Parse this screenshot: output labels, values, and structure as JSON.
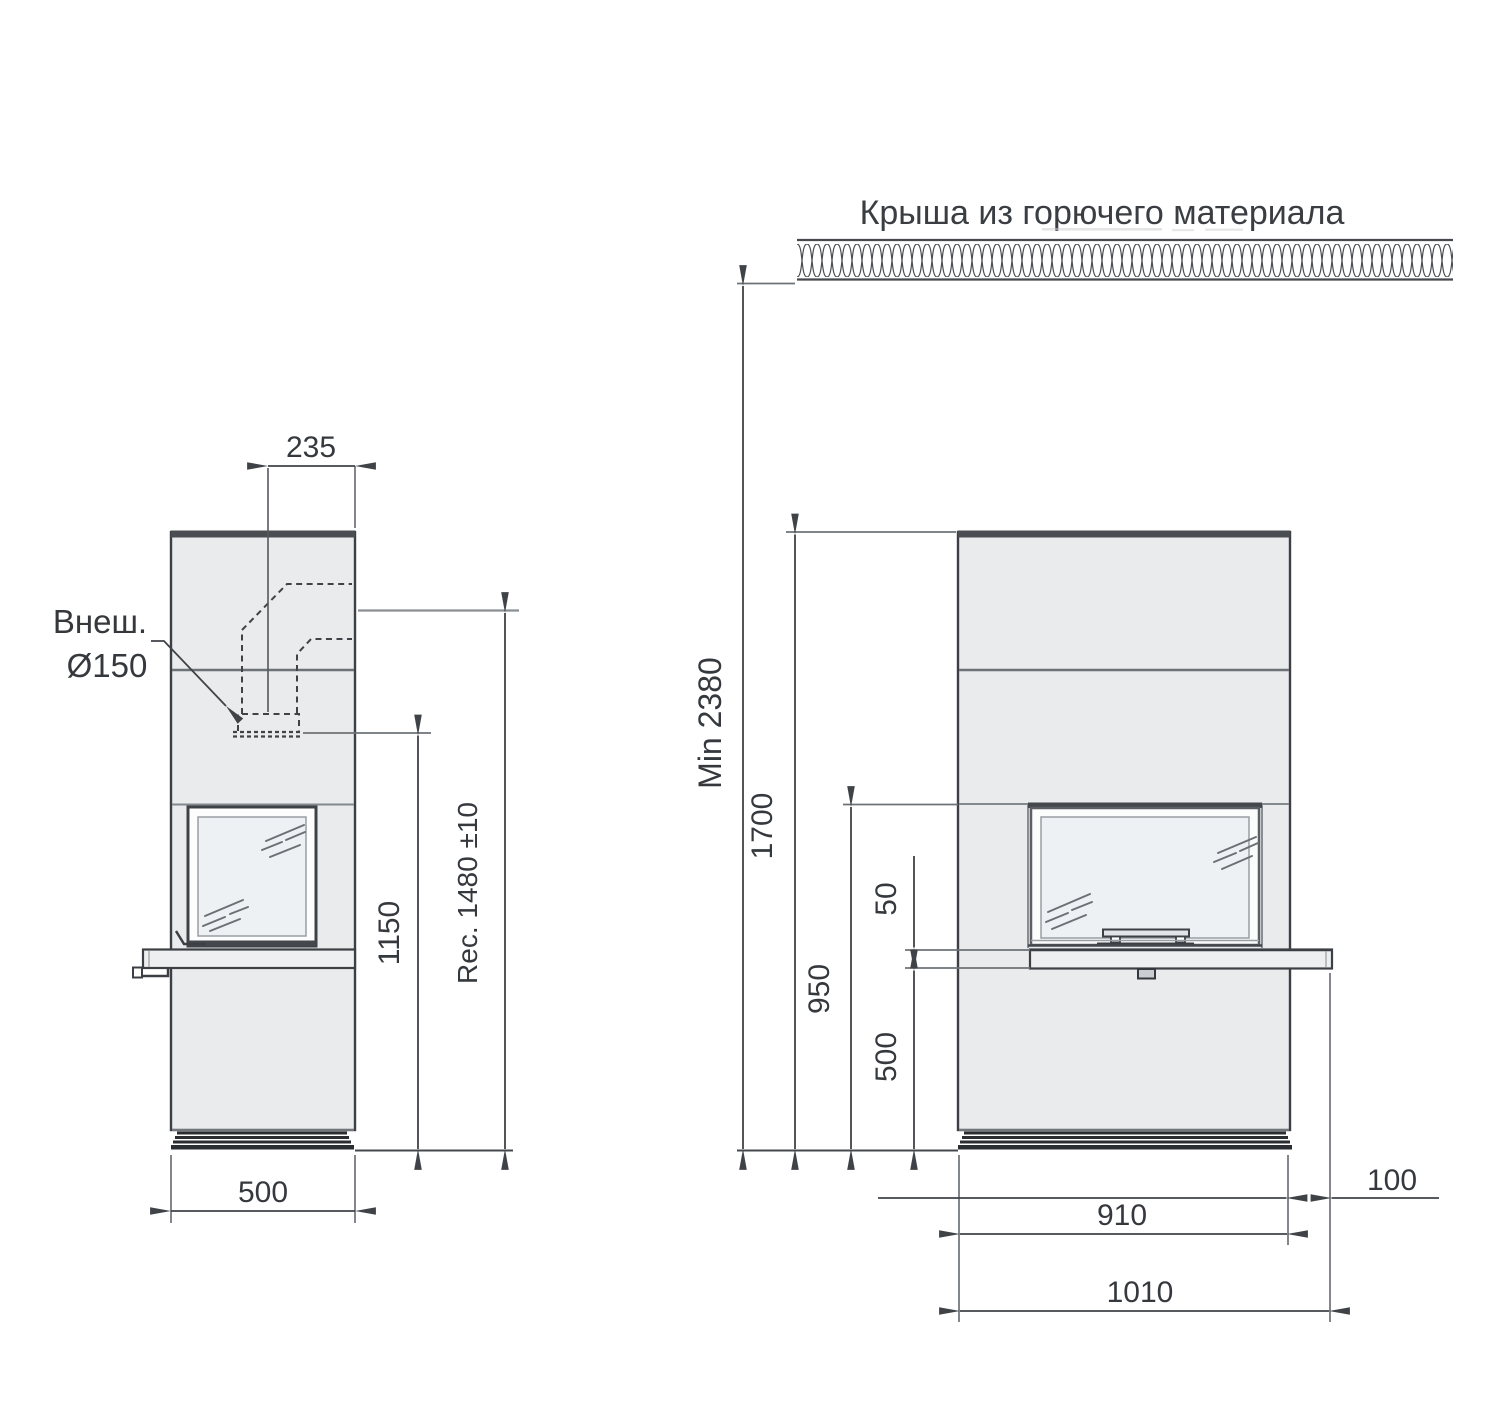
{
  "drawing": {
    "title": "Крыша из горючего материала",
    "palette": {
      "line": "#3f4347",
      "body_fill": "#e9ebed",
      "glass_fill": "#eef1f3",
      "bench_fill": "#edeff1",
      "cap_fill": "#4a4e52",
      "plinth_fill": "#2a2e32"
    },
    "side_view": {
      "flue_label": {
        "line1": "Внеш.",
        "line2": "Ø150"
      },
      "dims": {
        "flue_offset": "235",
        "rear_outlet_height": "1150",
        "top_outlet_height": "Rec. 1480 ±10",
        "depth": "500"
      }
    },
    "front_view": {
      "dims": {
        "ceiling_min": "Min 2380",
        "body_height": "1700",
        "opening_height": "950",
        "bench_thickness": "50",
        "bench_bottom_height": "500",
        "body_width": "910",
        "bench_overhang": "100",
        "overall_width": "1010"
      }
    }
  }
}
